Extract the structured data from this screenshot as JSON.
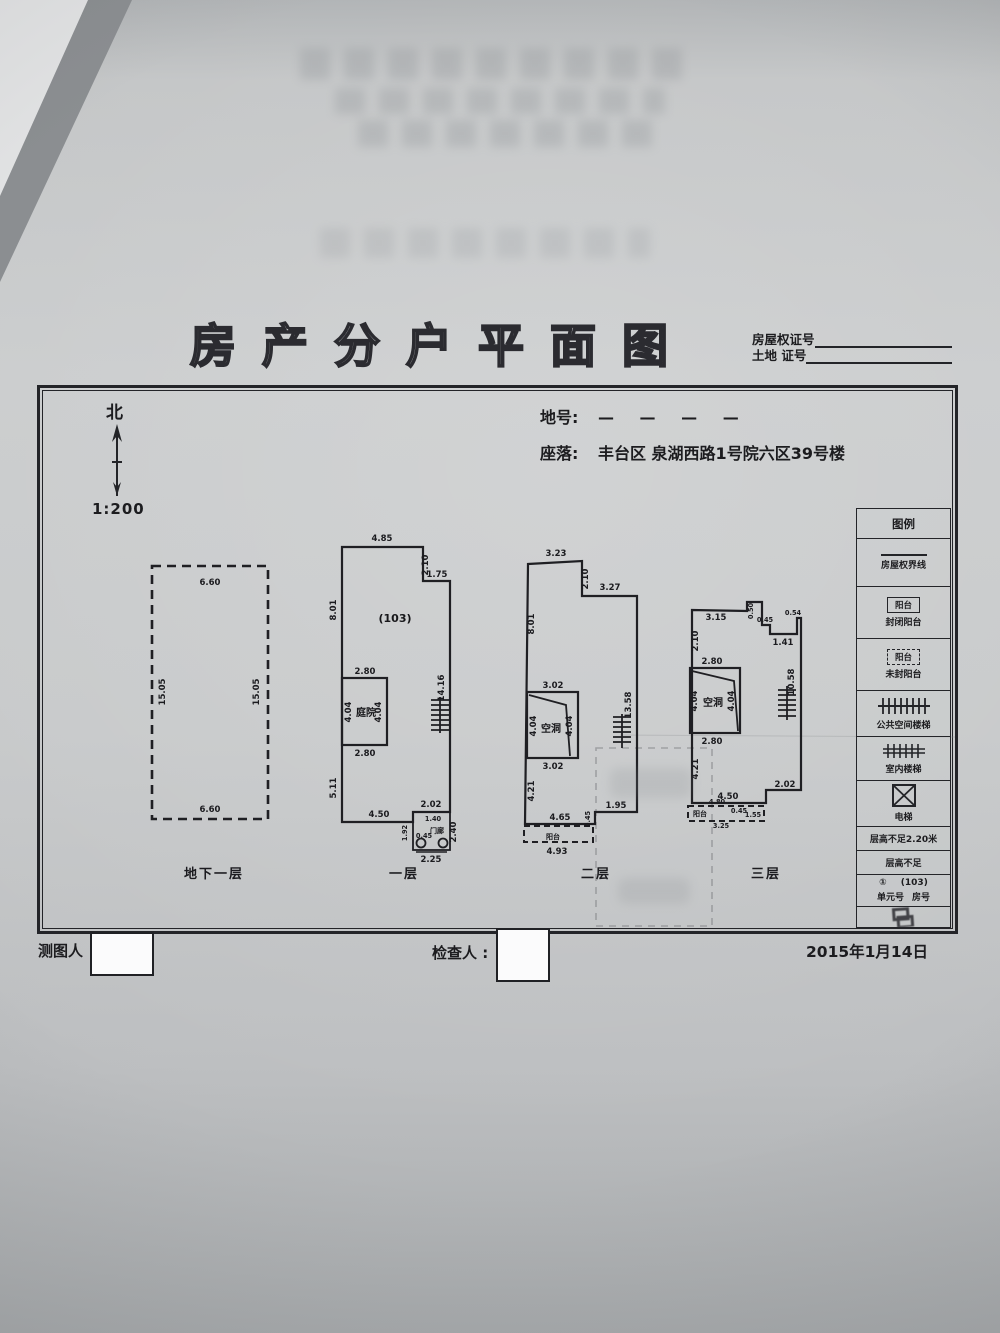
{
  "colors": {
    "ink": "#1f1f23",
    "paper": "#c9cbcc"
  },
  "title": "房产分户平面图",
  "cert": {
    "line1": "房屋权证号",
    "line2": "土地  证号"
  },
  "north": {
    "label": "北",
    "scale": "1:200"
  },
  "meta": {
    "lot_label": "地号:",
    "lot_value": "— — — —",
    "location_label": "座落:",
    "location_value": "丰台区 泉湖西路1号院六区39号楼"
  },
  "legend": {
    "title": "图例",
    "items": [
      {
        "label": "房屋权界线"
      },
      {
        "symbol_text": "阳台",
        "label": "封闭阳台"
      },
      {
        "symbol_text": "阳台",
        "label": "未封阳台"
      },
      {
        "label": "公共空间楼梯"
      },
      {
        "label": "室内楼梯"
      },
      {
        "label": "电梯"
      },
      {
        "label": "层高不足2.20米"
      },
      {
        "label": "层高不足"
      },
      {
        "unit_num": "①",
        "room_num": "(103)",
        "unit_label": "单元号",
        "room_label": "房号"
      }
    ]
  },
  "floors": {
    "basement": {
      "label": "地下一层",
      "dim_top": "6.60",
      "dim_bottom": "6.60",
      "dim_left": "15.05",
      "dim_right": "15.05"
    },
    "f1": {
      "label": "一层",
      "room_no": "(103)",
      "courtyard": "庭院",
      "porch": "门廊",
      "d_top": "4.85",
      "d_step_v": "2.10",
      "d_step_h": "1.75",
      "d_left_up": "8.01",
      "d_right": "14.16",
      "d_court_top": "2.80",
      "d_court_l": "4.04",
      "d_court_r": "4.04",
      "d_court_bottom": "2.80",
      "d_left_low": "5.11",
      "d_bottom": "4.50",
      "d_porch_top": "2.02",
      "d_porch_a": "1.40",
      "d_porch_b": "0.45",
      "d_porch_l": "1.92",
      "d_porch_r": "2.40",
      "d_porch_bottom": "2.25"
    },
    "f2": {
      "label": "二层",
      "void": "空洞",
      "balcony": "阳台",
      "d_top": "3.23",
      "d_step_v": "2.10",
      "d_step_h": "3.27",
      "d_left_up": "8.01",
      "d_right": "13.58",
      "d_void_top": "3.02",
      "d_void_l": "4.04",
      "d_void_r": "4.04",
      "d_void_bottom": "3.02",
      "d_left_low": "4.21",
      "d_bottom": "4.65",
      "d_step_r": "1.95",
      "d_step_s": "0.45",
      "d_balcony": "4.93"
    },
    "f3": {
      "label": "三层",
      "void": "空洞",
      "balcony": "阳台",
      "d_top": "3.15",
      "d_n1": "0.50",
      "d_n2": "0.45",
      "d_n3": "1.41",
      "d_n4": "0.54",
      "d_left_top": "2.10",
      "d_void_top": "2.80",
      "d_void_l": "4.04",
      "d_void_r": "4.04",
      "d_void_bottom": "2.80",
      "d_right": "10.58",
      "d_left_low": "4.21",
      "d_bottom": "4.50",
      "d_step_r": "2.02",
      "d_bal_a": "4.80",
      "d_bal_b": "3.25",
      "d_bal_c": "1.55",
      "d_bal_d": "0.45"
    }
  },
  "footer": {
    "surveyor_label": "测图人",
    "checker_label": "检查人 :",
    "date": "2015年1月14日"
  }
}
